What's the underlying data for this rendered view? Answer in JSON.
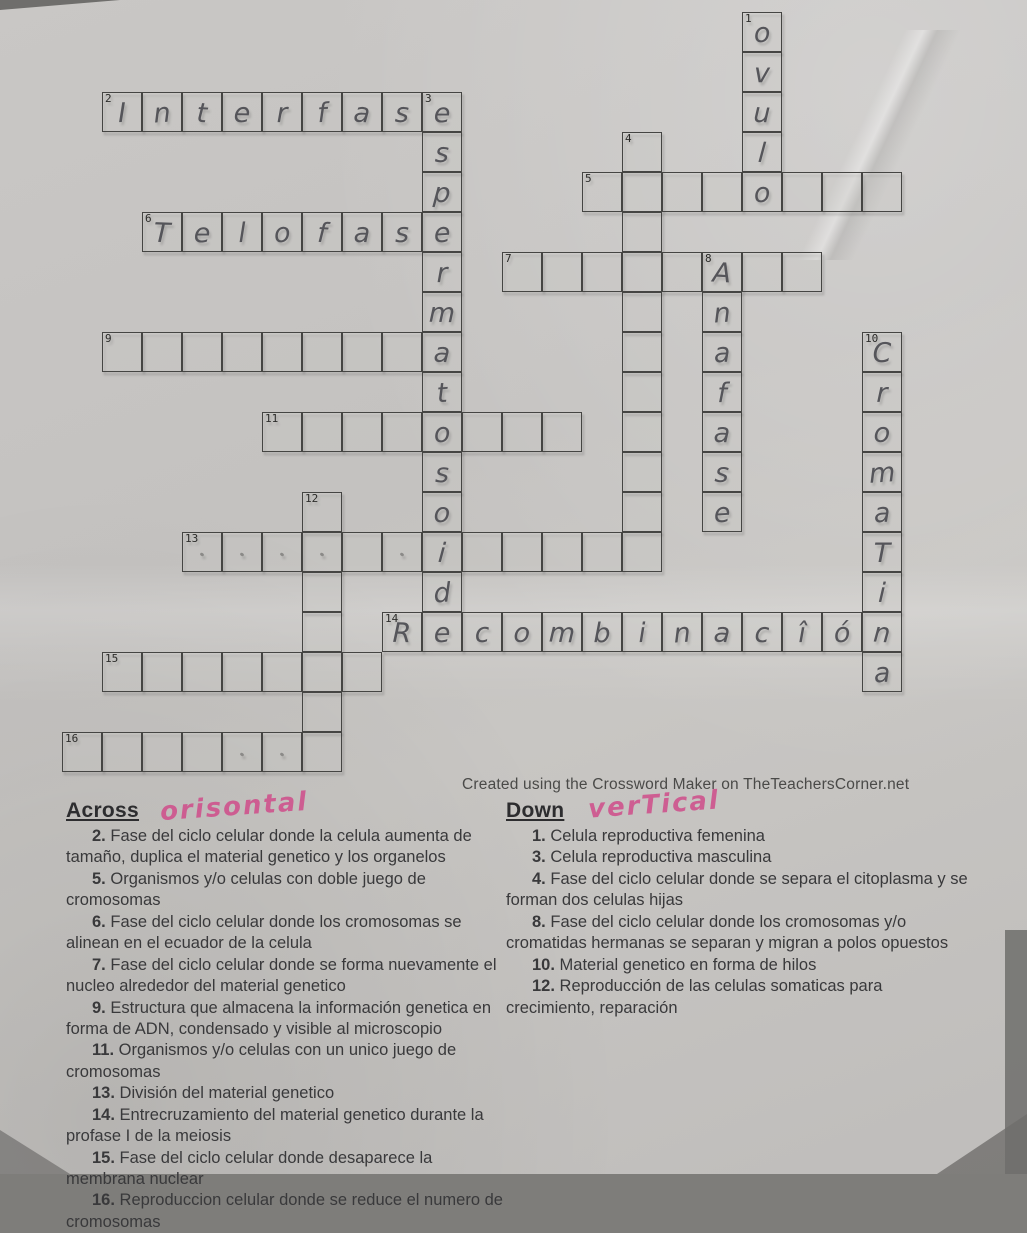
{
  "paper": {
    "attribution": "Created using the Crossword Maker on TheTeachersCorner.net"
  },
  "sections": {
    "across_label": "Across",
    "down_label": "Down"
  },
  "annotations": {
    "across_handwritten": "orisontal",
    "down_handwritten": "verTical",
    "ink_color": "#cf508c",
    "pencil_color": "#55555a"
  },
  "grid": {
    "cols": 21,
    "rows": 19,
    "cell_w": 40,
    "cell_h": 40,
    "origin_x": 62,
    "origin_y": 12,
    "words": [
      {
        "num": 2,
        "dir": "across",
        "col": 1,
        "row": 2,
        "len": 9,
        "letters": [
          "I",
          "n",
          "t",
          "e",
          "r",
          "f",
          "a",
          "s",
          "e"
        ]
      },
      {
        "num": 5,
        "dir": "across",
        "col": 13,
        "row": 4,
        "len": 8,
        "letters": [
          "",
          "",
          "",
          "",
          "",
          "",
          "",
          ""
        ]
      },
      {
        "num": 6,
        "dir": "across",
        "col": 2,
        "row": 5,
        "len": 8,
        "letters": [
          "T",
          "e",
          "l",
          "o",
          "f",
          "a",
          "s",
          "e"
        ]
      },
      {
        "num": 7,
        "dir": "across",
        "col": 11,
        "row": 6,
        "len": 8,
        "letters": [
          "",
          "",
          "",
          "",
          "",
          "",
          "",
          ""
        ]
      },
      {
        "num": 9,
        "dir": "across",
        "col": 1,
        "row": 8,
        "len": 9,
        "letters": [
          "",
          "",
          "",
          "",
          "",
          "",
          "",
          "",
          ""
        ]
      },
      {
        "num": 11,
        "dir": "across",
        "col": 5,
        "row": 10,
        "len": 8,
        "letters": [
          "",
          "",
          "",
          "",
          "",
          "",
          "",
          ""
        ]
      },
      {
        "num": 13,
        "dir": "across",
        "col": 3,
        "row": 13,
        "len": 12,
        "letters": [
          "",
          "",
          "",
          "",
          "",
          "",
          "",
          "",
          "",
          "",
          "",
          ""
        ]
      },
      {
        "num": 14,
        "dir": "across",
        "col": 8,
        "row": 15,
        "len": 13,
        "letters": [
          "R",
          "e",
          "c",
          "o",
          "m",
          "b",
          "i",
          "n",
          "a",
          "c",
          "î",
          "ó",
          "n"
        ]
      },
      {
        "num": 15,
        "dir": "across",
        "col": 1,
        "row": 16,
        "len": 7,
        "letters": [
          "",
          "",
          "",
          "",
          "",
          "",
          ""
        ]
      },
      {
        "num": 16,
        "dir": "across",
        "col": 0,
        "row": 18,
        "len": 7,
        "letters": [
          "",
          "",
          "",
          "",
          "",
          "",
          ""
        ]
      },
      {
        "num": 1,
        "dir": "down",
        "col": 17,
        "row": 0,
        "len": 5,
        "letters": [
          "o",
          "v",
          "u",
          "l",
          "o"
        ]
      },
      {
        "num": 3,
        "dir": "down",
        "col": 9,
        "row": 2,
        "len": 14,
        "letters": [
          "e",
          "s",
          "p",
          "e",
          "r",
          "m",
          "a",
          "t",
          "o",
          "s",
          "o",
          "i",
          "d",
          "e"
        ]
      },
      {
        "num": 4,
        "dir": "down",
        "col": 14,
        "row": 3,
        "len": 11,
        "letters": [
          "",
          "",
          "",
          "",
          "",
          "",
          "",
          "",
          "",
          "",
          ""
        ]
      },
      {
        "num": 8,
        "dir": "down",
        "col": 16,
        "row": 6,
        "len": 7,
        "letters": [
          "A",
          "n",
          "a",
          "f",
          "a",
          "s",
          "e"
        ]
      },
      {
        "num": 10,
        "dir": "down",
        "col": 20,
        "row": 8,
        "len": 9,
        "letters": [
          "C",
          "r",
          "o",
          "m",
          "a",
          "T",
          "i",
          "n",
          "a"
        ]
      },
      {
        "num": 12,
        "dir": "down",
        "col": 6,
        "row": 12,
        "len": 7,
        "letters": [
          "",
          "",
          "",
          "",
          "",
          "",
          ""
        ]
      }
    ],
    "stray_dots": [
      [
        3,
        13
      ],
      [
        4,
        13
      ],
      [
        5,
        13
      ],
      [
        6,
        13
      ],
      [
        8,
        13
      ],
      [
        4,
        18
      ],
      [
        5,
        18
      ]
    ]
  },
  "clues": {
    "across": [
      {
        "num": "2",
        "text": "Fase del ciclo celular donde la celula aumenta de tamaño, duplica el material genetico y los organelos"
      },
      {
        "num": "5",
        "text": "Organismos y/o celulas con doble juego de cromosomas"
      },
      {
        "num": "6",
        "text": "Fase del ciclo celular donde los cromosomas se alinean en el ecuador de la celula"
      },
      {
        "num": "7",
        "text": "Fase del ciclo celular donde se forma nuevamente el nucleo alrededor del material genetico"
      },
      {
        "num": "9",
        "text": "Estructura que almacena la información genetica en forma de ADN, condensado y visible al microscopio"
      },
      {
        "num": "11",
        "text": "Organismos y/o celulas con un unico juego de cromosomas"
      },
      {
        "num": "13",
        "text": "División del material genetico"
      },
      {
        "num": "14",
        "text": "Entrecruzamiento del material genetico durante la profase I de la meiosis"
      },
      {
        "num": "15",
        "text": "Fase del ciclo celular donde desaparece la membrana nuclear"
      },
      {
        "num": "16",
        "text": "Reproduccion celular donde se reduce el numero de cromosomas"
      }
    ],
    "down": [
      {
        "num": "1",
        "text": "Celula reproductiva femenina"
      },
      {
        "num": "3",
        "text": "Celula reproductiva masculina"
      },
      {
        "num": "4",
        "text": "Fase del ciclo celular donde se separa el citoplasma y se forman dos celulas hijas"
      },
      {
        "num": "8",
        "text": "Fase del ciclo celular donde los cromosomas y/o cromatidas hermanas se separan y migran a polos opuestos"
      },
      {
        "num": "10",
        "text": "Material genetico en forma de hilos"
      },
      {
        "num": "12",
        "text": "Reproducción de las celulas somaticas para crecimiento, reparación"
      }
    ]
  }
}
